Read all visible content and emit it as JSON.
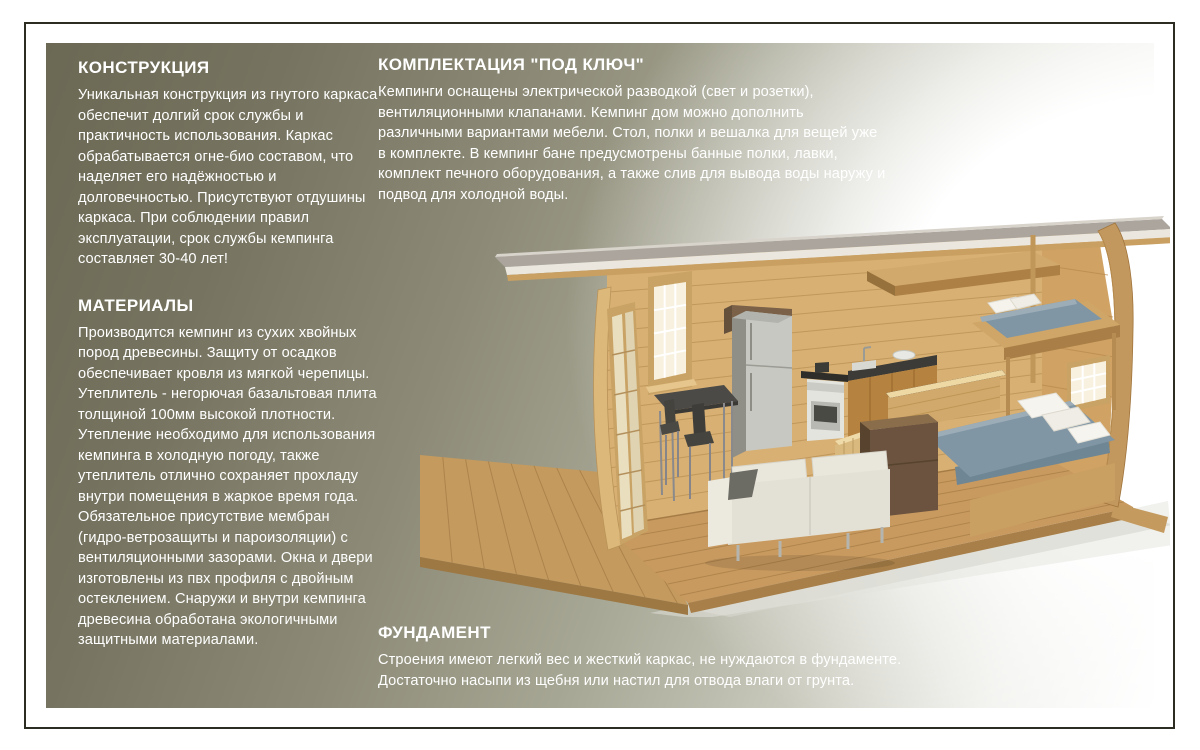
{
  "page": {
    "background_color": "#ffffff",
    "frame_color": "#2c2c23",
    "panel_gradient": [
      "#6b6954",
      "#a7a795",
      "#ffffff"
    ],
    "text_color": "#ffffff"
  },
  "sections": {
    "construction": {
      "heading": "КОНСТРУКЦИЯ",
      "body": "Уникальная конструкция из гнутого каркаса обеспечит долгий срок службы и практичность использования. Каркас обрабатывается огне-био составом, что наделяет его надёжностью и долговечностью. Присутствуют отдушины каркаса. При соблюдении правил эксплуатации, срок службы кемпинга составляет 30-40 лет!"
    },
    "materials": {
      "heading": "МАТЕРИАЛЫ",
      "body": "Производится кемпинг из сухих хвойных пород древесины. Защиту от осадков обеспечивает кровля из мягкой черепицы.  Утеплитель - негорючая базальтовая плита толщиной 100мм высокой плотности. Утепление необходимо для использования кемпинга в холодную погоду, также утеплитель отлично сохраняет прохладу внутри помещения в жаркое время года. Обязательное присутствие мембран (гидро-ветрозащиты и пароизоляции) с вентиляционными зазорами. Окна и двери изготовлены из пвх профиля с двойным остеклением. Снаружи и внутри кемпинга древесина обработана экологичными  защитными материалами."
    },
    "package": {
      "heading": "КОМПЛЕКТАЦИЯ \"ПОД КЛЮЧ\"",
      "body": "Кемпинги оснащены электрической разводкой (свет и розетки), вентиляционными клапанами. Кемпинг дом можно дополнить различными вариантами мебели. Стол, полки и вешалка для вещей уже в комплекте. В кемпинг бане предусмотрены банные полки, лавки, комплект печного оборудования, а также слив для вывода воды наружу и подвод для холодной воды."
    },
    "foundation": {
      "heading": "ФУНДАМЕНТ",
      "body": "Строения имеют легкий вес и жесткий каркас, не нуждаются в фундаменте. Достаточно насыпи из щебня или настил для отвода влаги от грунта."
    }
  },
  "illustration": {
    "description": "camping-house-cutaway-render",
    "colors": {
      "wall_wood": "#d8b073",
      "floor_wood": "#c89a5f",
      "arch_wood": "#c3985e",
      "roof_grey": "#aba59d",
      "mattress_slate": "#8096a4",
      "sofa_white": "#e6e3d8",
      "fridge_steel": "#c7c8c1",
      "dresser_walnut": "#6b5340"
    }
  }
}
